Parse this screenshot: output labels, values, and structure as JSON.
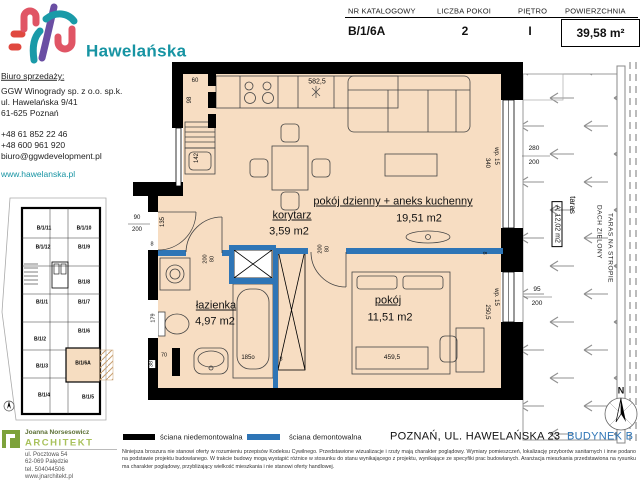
{
  "brand": {
    "name": "Hawelańska"
  },
  "header": {
    "cat_label": "NR KATALOGOWY",
    "cat_value": "B/1/6A",
    "rooms_label": "LICZBA POKOI",
    "rooms_value": "2",
    "floor_label": "PIĘTRO",
    "floor_value": "I",
    "area_label": "POWIERZCHNIA",
    "area_value": "39,58 m²"
  },
  "office": {
    "heading": "Biuro sprzedaży:",
    "company": "GGW Winogrady sp. z o.o. sp.k.",
    "street": "ul. Hawelańska 9/41",
    "city": "61-625 Poznań",
    "phone1": "+48 61 852 22 46",
    "phone2": "+48 600 961 920",
    "email": "biuro@ggwdevelopment.pl",
    "website": "www.hawelanska.pl"
  },
  "minimap": {
    "units": [
      "B/1/11",
      "B/1/10",
      "B/1/12",
      "B/1/9",
      "B/1/8",
      "B/1/1",
      "B/1/7",
      "B/1/2",
      "B/1/6",
      "B/1/3",
      "B/1/6A",
      "B/1/4",
      "B/1/5"
    ]
  },
  "rooms": {
    "hall": {
      "name": "korytarz",
      "area": "3,59 m2"
    },
    "living": {
      "name": "pokój dzienny + aneks kuchenny",
      "area": "19,51 m2"
    },
    "bath": {
      "name": "łazienka",
      "area": "4,97 m2"
    },
    "bedroom": {
      "name": "pokój",
      "area": "11,51 m2"
    }
  },
  "terrace": {
    "name": "taras",
    "area": "A: 12,02 m2",
    "note1": "TARAS NA STROPIE",
    "note2": "DACH ZIELONY"
  },
  "dims": {
    "kitchen_run": "582,5",
    "shaft_w": "60",
    "shaft_h": "98",
    "unit_h": "142",
    "hall_h": "135",
    "entry_w": "90",
    "entry_h": "200",
    "wall_a": "8",
    "wall_b": "8",
    "wall_c": "8",
    "bath_door_w": "80",
    "bath_door_h": "200",
    "bed_door_w": "80",
    "bed_door_h": "200",
    "toilet_h": "179",
    "toilet_w": "70",
    "toilet_d": "38",
    "bathtub": "185o",
    "bed_len": "459,5",
    "living_win_sill": "wp. 15",
    "living_win_w": "340",
    "bed_win_sill": "wp. 15",
    "bed_win_w": "250,5",
    "ter_living_a": "280",
    "ter_living_b": "200",
    "ter_bed_a": "95",
    "ter_bed_b": "200"
  },
  "legend": {
    "fixed": "ściana niedemontowalna",
    "removable": "ściana demontowalna"
  },
  "footer": {
    "address": "POZNAŃ, UL. HAWELAŃSKA 23",
    "building": "BUDYNEK B",
    "disclaimer": "Niniejsza broszura nie stanowi oferty w rozumieniu przepisów Kodeksu Cywilnego. Przedstawione wizualizacje i rzuty mają charakter poglądowy. Wymiary pomieszczeń, lokalizację przyborów sanitarnych i inne podano na podstawie projektu budowlanego. W trakcie budowy mogą wystąpić różnice w stosunku do stanu wynikającego z projektu, wynikające ze specyfiki prac budowlanych. Aranżacja mieszkania przedstawiona na rysunku ma charakter poglądowy, przybliżający wielkość mieszkania i nie stanowi oferty handlowej."
  },
  "architect": {
    "name": "Joanna Norsesowicz",
    "title": "ARCHITEKT",
    "street": "ul. Pocztowa 54",
    "city": "62-069 Palędzie",
    "phone": "tel. 504044506",
    "website": "www.jnarchitekt.pl"
  },
  "compass": {
    "n": "N"
  },
  "colors": {
    "accent_teal": "#1794a3",
    "wall_black": "#000000",
    "wall_blue": "#2e75b6",
    "floor": "#f7ddc2",
    "architect_green": "#a9c25c"
  }
}
